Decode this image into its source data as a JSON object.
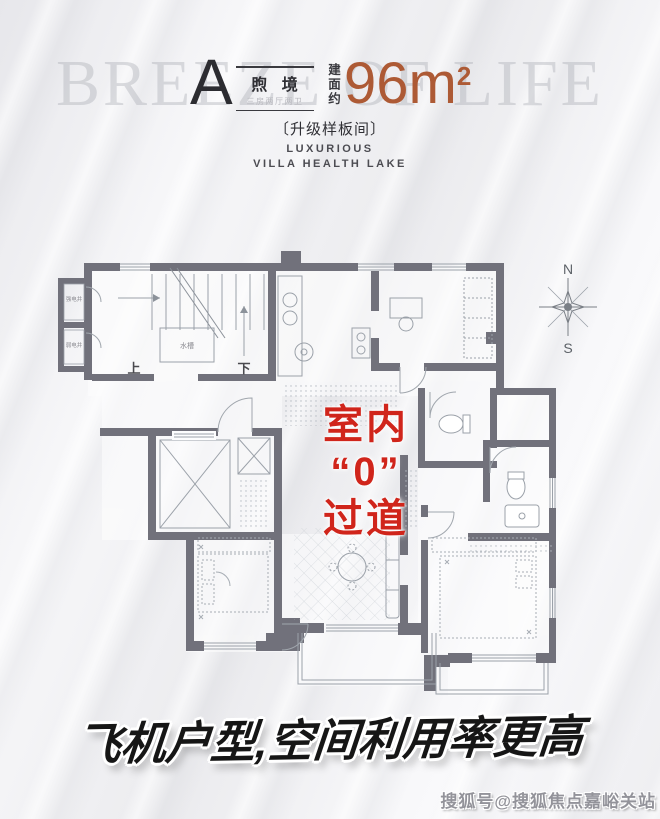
{
  "watermark": {
    "background_text": "BREEZE OF LIFE",
    "credit": "搜狐号@搜狐焦点嘉峪关站"
  },
  "header": {
    "unit": "A",
    "unit_name": "煦 境",
    "unit_layout": "三房两厅两卫",
    "area_prefix": "建面约",
    "area_value": "96m",
    "area_exponent": "2",
    "upgrade_note": "〔升级样板间〕",
    "tagline_line1": "LUXURIOUS",
    "tagline_line2": "VILLA HEALTH LAKE",
    "accent_color": "#ad5a35"
  },
  "plan": {
    "wall_color": "#71717b",
    "labels": {
      "up": "上",
      "down": "下",
      "north": "N",
      "south": "S",
      "strong_electric_shaft": "强电井",
      "weak_electric_shaft": "弱电井",
      "sink": "水槽"
    }
  },
  "overlay": {
    "line1": "室内",
    "line2": "“0”",
    "line3": "过道",
    "color": "#d0251b"
  },
  "banner": {
    "text": "飞机户型,空间利用率更高"
  }
}
